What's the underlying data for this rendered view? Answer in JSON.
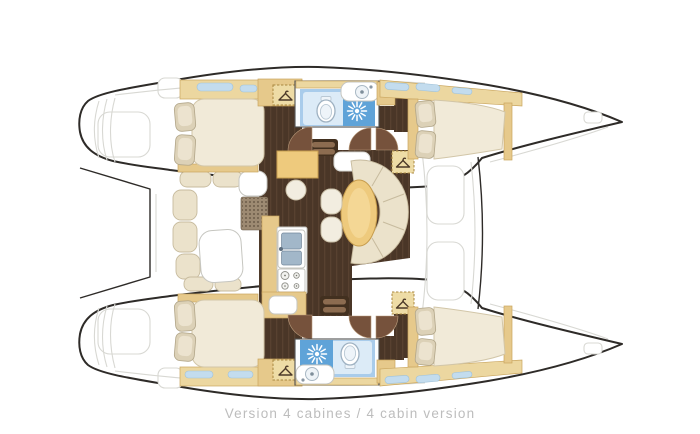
{
  "caption": "Version 4 cabines / 4 cabin version",
  "colors": {
    "outline": "#2e2b28",
    "faint": "#d8d8d3",
    "wood_light": "#ecd7a0",
    "wood_mid": "#e6c98b",
    "wood_edge": "#c9a55e",
    "floor_base": "#4a3627",
    "floor_grain": "#584130",
    "door": "#76523c",
    "door_edge": "#bb9c7c",
    "mattress": "#f1ead8",
    "mattress_edge": "#d2c6a8",
    "pillow": "#dcd1b7",
    "pillow_edge": "#b2a689",
    "pillow_hi": "#ece3cf",
    "cushion": "#ebe2cb",
    "cushion_edge": "#c7bb9e",
    "white_furn_edge": "#c6c6c0",
    "bath_frame": "#4f4f4f",
    "bath_base": "#fbfdfe",
    "bath_light": "#dcebf7",
    "bath_mid": "#a9cceb",
    "bath_deep": "#5fa3d8",
    "window": "#c3dcee",
    "window_edge": "#9fc2da",
    "steel": "#a2b7c9",
    "steel_edge": "#74889b",
    "grate": "#9d8a72",
    "grate_dot": "#5e4e3c",
    "step_frame": "#42301f",
    "step_bar": "#8c6c50",
    "locker_fill": "#eedca6",
    "locker_dash": "#a8863f",
    "hanger": "#4c3928",
    "stool": "#f2ede0",
    "stool_edge": "#cbc1a9",
    "table_wood": "#eeca7d",
    "table_edge": "#c79d4e",
    "caption": "#bdbdbd",
    "page_bg": "#ffffff"
  },
  "icons": [
    "hanger-icon",
    "shower-head-icon",
    "toilet-icon",
    "sink-basin-icon",
    "stove-burners-icon",
    "companionway-steps-icon",
    "engine-hatch-grate-icon"
  ]
}
